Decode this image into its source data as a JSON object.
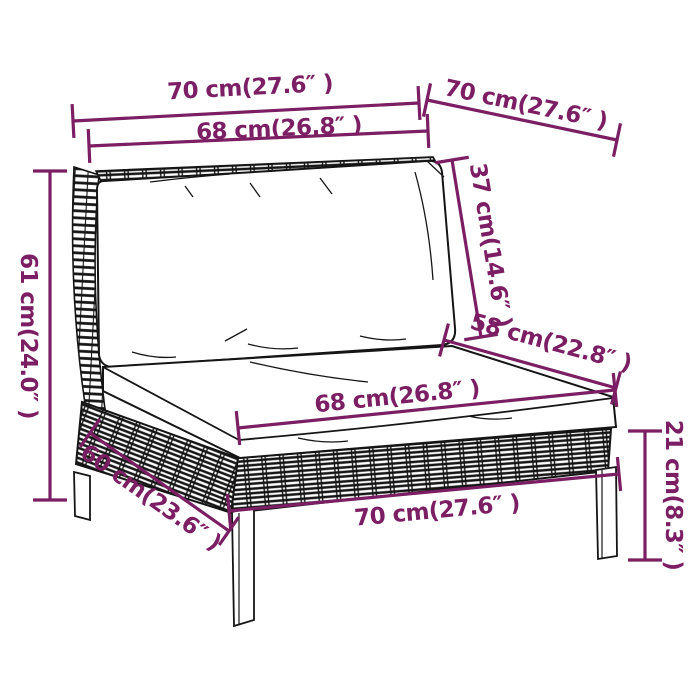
{
  "diagram": {
    "type": "product-dimension-diagram",
    "subject": "rattan-garden-sofa-middle-section-with-cushions",
    "background": "#ffffff",
    "art_color": "#151515",
    "dimension_color": "#7b1e63"
  },
  "dimensions": [
    {
      "id": "top-width",
      "label": "70 cm(27.6″ )"
    },
    {
      "id": "top-depth",
      "label": "70 cm(27.6″ )"
    },
    {
      "id": "backrest-width",
      "label": "68 cm(26.8″ )"
    },
    {
      "id": "backrest-height",
      "label": "37 cm(14.6″ )"
    },
    {
      "id": "seat-depth",
      "label": "58 cm(22.8″ )"
    },
    {
      "id": "total-height",
      "label": "61 cm(24.0″ )"
    },
    {
      "id": "seat-width",
      "label": "68 cm(26.8″ )"
    },
    {
      "id": "base-depth",
      "label": "60 cm(23.6″ )"
    },
    {
      "id": "base-width",
      "label": "70 cm(27.6″ )"
    },
    {
      "id": "leg-height",
      "label": "21 cm(8.3″ )"
    }
  ]
}
